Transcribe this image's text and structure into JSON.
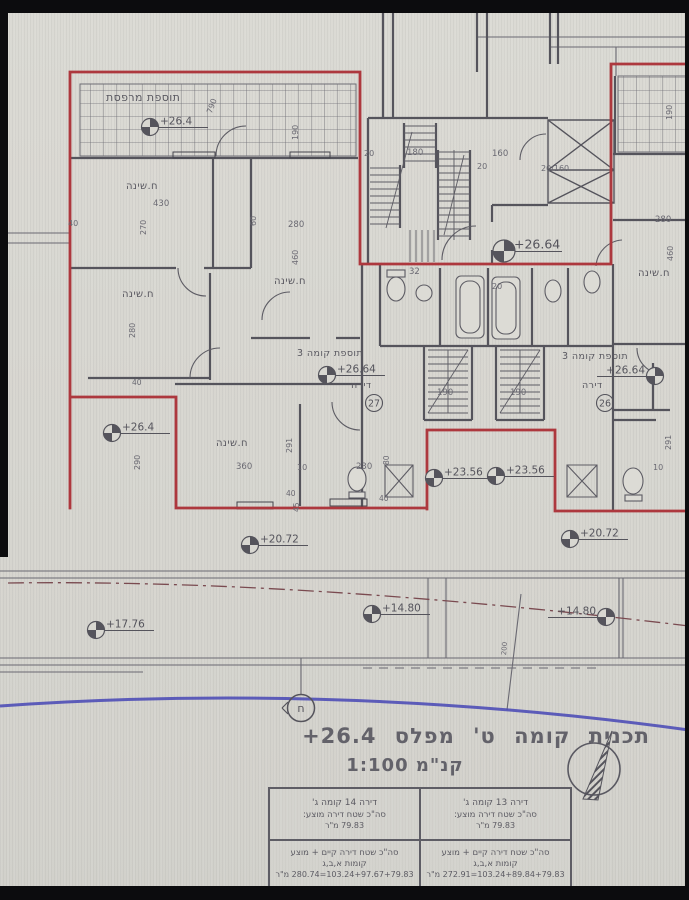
{
  "colors": {
    "ink": "#55545c",
    "dim": "#6a6972",
    "red": "#ad383e",
    "blue": "#4747b5",
    "paper": "#d8d7d1"
  },
  "title": {
    "text": "תכנית קומה ט' מפלס",
    "level": "+26.4",
    "scale": "קנ\"מ 1:100"
  },
  "table": {
    "top_right": {
      "line1": "דירה 13 קומה ג'",
      "line2": "סה\"כ שטח דירה מוצע:",
      "line3": "79.83 מ\"ר"
    },
    "top_left": {
      "line1": "דירה 14 קומה ג'",
      "line2": "סה\"כ שטח דירה מוצע:",
      "line3": "79.83 מ\"ר"
    },
    "bottom_right": {
      "line1": "סה\"כ שטח דירה קיים + מוצע",
      "line2": "קומות א,ב,ג",
      "line3": "103.24+89.84+79.83=272.91 מ\"ר"
    },
    "bottom_left": {
      "line1": "סה\"כ שטח דירה קיים + מוצע",
      "line2": "קומות א,ב,ג",
      "line3": "103.24+97.67+79.83=280.74 מ\"ר"
    }
  },
  "plan": {
    "texts": [
      {
        "t": "תוספת מרפסת",
        "x": 106,
        "y": 92,
        "s": 11,
        "heb": 1,
        "name": "balcony-addition-label"
      },
      {
        "t": "790",
        "x": 206,
        "y": 112,
        "s": 8,
        "r": -70
      },
      {
        "t": "190",
        "x": 292,
        "y": 140,
        "s": 8,
        "r": -90
      },
      {
        "t": "40",
        "x": 68,
        "y": 220,
        "s": 8
      },
      {
        "t": "280",
        "x": 288,
        "y": 221,
        "s": 8.5
      },
      {
        "t": "460",
        "x": 292,
        "y": 265,
        "s": 8,
        "r": -90
      },
      {
        "t": "430",
        "x": 153,
        "y": 200,
        "s": 8.5
      },
      {
        "t": "270",
        "x": 140,
        "y": 235,
        "s": 8,
        "r": -90
      },
      {
        "t": "60",
        "x": 250,
        "y": 226,
        "s": 8,
        "r": -90
      },
      {
        "t": "ח.שינה",
        "x": 126,
        "y": 182,
        "s": 10,
        "heb": 1,
        "name": "room-label-bedroom"
      },
      {
        "t": "ח.שינה",
        "x": 122,
        "y": 290,
        "s": 10,
        "heb": 1,
        "name": "room-label-bedroom"
      },
      {
        "t": "ח.שינה",
        "x": 274,
        "y": 277,
        "s": 10,
        "heb": 1,
        "name": "room-label-bedroom"
      },
      {
        "t": "ח.שינה",
        "x": 216,
        "y": 439,
        "s": 10,
        "heb": 1,
        "name": "room-label-bedroom"
      },
      {
        "t": "ח.שינה",
        "x": 638,
        "y": 269,
        "s": 10,
        "heb": 1,
        "name": "room-label-bedroom"
      },
      {
        "t": "280",
        "x": 129,
        "y": 338,
        "s": 8,
        "r": -90
      },
      {
        "t": "40",
        "x": 132,
        "y": 379,
        "s": 7.5
      },
      {
        "t": "290",
        "x": 134,
        "y": 470,
        "s": 8,
        "r": -90
      },
      {
        "t": "תוספת קומה 3",
        "x": 297,
        "y": 349,
        "s": 9.5,
        "heb": 1,
        "name": "floor-addition-label"
      },
      {
        "t": "דירה",
        "x": 351,
        "y": 381,
        "s": 9.5,
        "heb": 1,
        "name": "apartment-label"
      },
      {
        "t": "תוספת קומה 3",
        "x": 562,
        "y": 352,
        "s": 9.5,
        "heb": 1,
        "name": "floor-addition-label"
      },
      {
        "t": "דירה",
        "x": 582,
        "y": 381,
        "s": 9.5,
        "heb": 1,
        "name": "apartment-label"
      },
      {
        "t": "291",
        "x": 286,
        "y": 453,
        "s": 8,
        "r": -90
      },
      {
        "t": "360",
        "x": 236,
        "y": 463,
        "s": 8.5
      },
      {
        "t": "10",
        "x": 297,
        "y": 464,
        "s": 8
      },
      {
        "t": "230",
        "x": 356,
        "y": 463,
        "s": 8.5
      },
      {
        "t": "80",
        "x": 383,
        "y": 465,
        "s": 7.5,
        "r": -90
      },
      {
        "t": "40",
        "x": 286,
        "y": 490,
        "s": 7.5
      },
      {
        "t": "40",
        "x": 379,
        "y": 495,
        "s": 7.5
      },
      {
        "t": "20",
        "x": 364,
        "y": 150,
        "s": 8
      },
      {
        "t": "180",
        "x": 407,
        "y": 149,
        "s": 8.5
      },
      {
        "t": "160",
        "x": 492,
        "y": 150,
        "s": 8.5
      },
      {
        "t": "20",
        "x": 477,
        "y": 163,
        "s": 8
      },
      {
        "t": "20/160",
        "x": 541,
        "y": 165,
        "s": 8
      },
      {
        "t": "32",
        "x": 409,
        "y": 268,
        "s": 8.5
      },
      {
        "t": "20",
        "x": 492,
        "y": 283,
        "s": 8
      },
      {
        "t": "190",
        "x": 437,
        "y": 389,
        "s": 8.5
      },
      {
        "t": "190",
        "x": 510,
        "y": 389,
        "s": 8.5
      },
      {
        "t": "190",
        "x": 666,
        "y": 120,
        "s": 8,
        "r": -90
      },
      {
        "t": "280",
        "x": 655,
        "y": 216,
        "s": 8.5
      },
      {
        "t": "460",
        "x": 667,
        "y": 261,
        "s": 8,
        "r": -90
      },
      {
        "t": "291",
        "x": 665,
        "y": 450,
        "s": 8,
        "r": -90
      },
      {
        "t": "10",
        "x": 653,
        "y": 464,
        "s": 8
      },
      {
        "t": "200",
        "x": 501,
        "y": 655,
        "s": 7,
        "r": -85
      },
      {
        "t": "45",
        "x": 293,
        "y": 512,
        "s": 7.5,
        "r": -90
      }
    ],
    "level_markers": [
      {
        "x": 150,
        "y": 127,
        "label": "+26.4",
        "side": "right"
      },
      {
        "x": 112,
        "y": 433,
        "label": "+26.4",
        "side": "right"
      },
      {
        "x": 504,
        "y": 251,
        "label": "+26.64",
        "side": "right",
        "big": true
      },
      {
        "x": 327,
        "y": 375,
        "label": "+26.64",
        "side": "right"
      },
      {
        "x": 655,
        "y": 376,
        "label": "+26.64",
        "side": "left"
      },
      {
        "x": 434,
        "y": 478,
        "label": "+23.56",
        "side": "right"
      },
      {
        "x": 496,
        "y": 476,
        "label": "+23.56",
        "side": "right"
      },
      {
        "x": 250,
        "y": 545,
        "label": "+20.72",
        "side": "right"
      },
      {
        "x": 570,
        "y": 539,
        "label": "+20.72",
        "side": "right"
      },
      {
        "x": 96,
        "y": 630,
        "label": "+17.76",
        "side": "right"
      },
      {
        "x": 372,
        "y": 614,
        "label": "+14.80",
        "side": "right"
      },
      {
        "x": 606,
        "y": 617,
        "label": "+14.80",
        "side": "left"
      }
    ],
    "apartment_circles": [
      {
        "x": 374,
        "y": 403,
        "label": "27"
      },
      {
        "x": 605,
        "y": 403,
        "label": "26"
      }
    ],
    "section_mark": {
      "x": 301,
      "y": 708,
      "label": "ח"
    }
  }
}
